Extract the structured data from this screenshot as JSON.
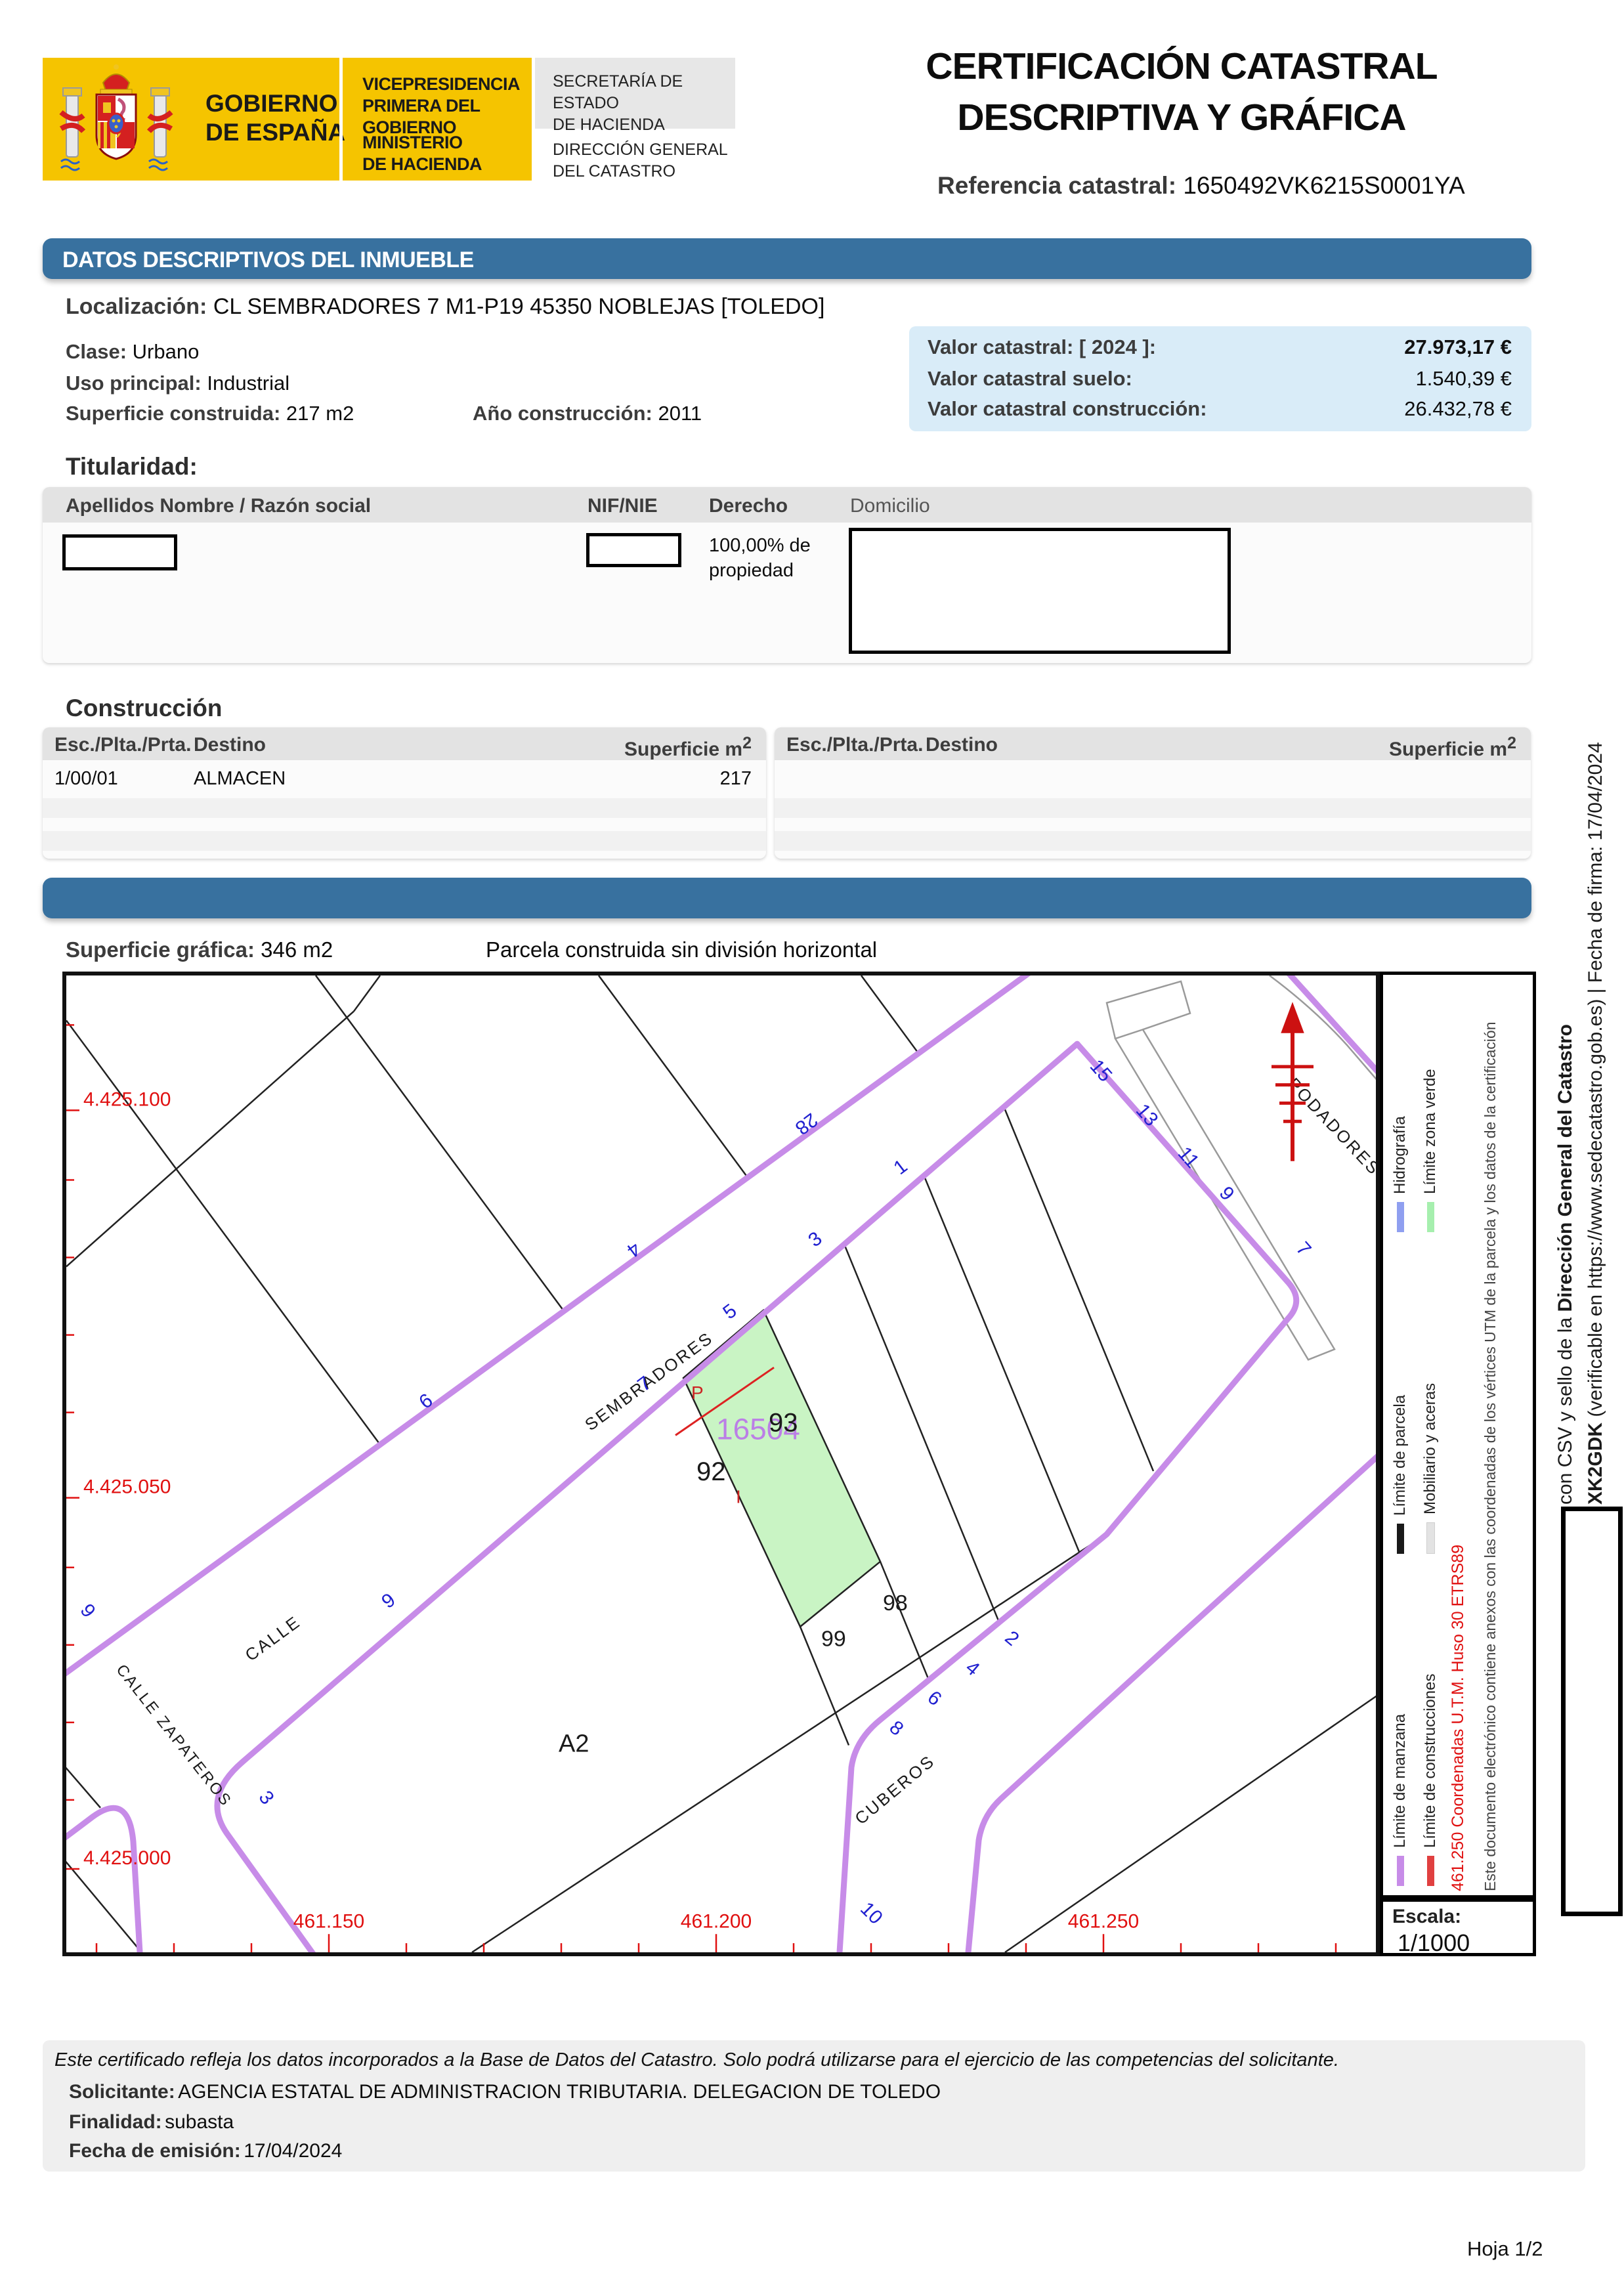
{
  "header": {
    "gobierno1": "GOBIERNO",
    "gobierno2": "DE ESPAÑA",
    "vicepresidencia1": "VICEPRESIDENCIA",
    "vicepresidencia2": "PRIMERA DEL GOBIERNO",
    "ministerio1": "MINISTERIO",
    "ministerio2": "DE HACIENDA",
    "secretaria1": "SECRETARÍA DE ESTADO",
    "secretaria2": "DE HACIENDA",
    "direccion1": "DIRECCIÓN GENERAL",
    "direccion2": "DEL CATASTRO",
    "title1": "CERTIFICACIÓN CATASTRAL",
    "title2": "DESCRIPTIVA Y GRÁFICA",
    "ref_label": "Referencia catastral:",
    "ref_value": "1650492VK6215S0001YA"
  },
  "datos": {
    "bar_title": "DATOS DESCRIPTIVOS DEL INMUEBLE",
    "localizacion_label": "Localización:",
    "localizacion": "CL SEMBRADORES 7 M1-P19 45350 NOBLEJAS [TOLEDO]",
    "clase_label": "Clase:",
    "clase": "Urbano",
    "uso_label": "Uso principal:",
    "uso": "Industrial",
    "superficie_label": "Superficie construida:",
    "superficie": "217 m2",
    "anio_label": "Año construcción:",
    "anio": "2011",
    "valor": {
      "label": "Valor catastral:",
      "year": "[ 2024 ]:",
      "total": "27.973,17 €",
      "suelo_label": "Valor catastral suelo:",
      "suelo": "1.540,39 €",
      "construccion_label": "Valor catastral construcción:",
      "construccion": "26.432,78 €"
    }
  },
  "titularidad": {
    "title": "Titularidad:",
    "headers": [
      "Apellidos Nombre / Razón social",
      "NIF/NIE",
      "Derecho",
      "Domicilio"
    ],
    "derecho1": "100,00% de",
    "derecho2": "propiedad"
  },
  "construccion": {
    "title": "Construcción",
    "col_esc": "Esc./Plta./Prta.",
    "col_destino": "Destino",
    "col_superficie": "Superficie m",
    "col_superficie_sup": "2",
    "rows": [
      {
        "esc": "1/00/01",
        "destino": "ALMACEN",
        "superficie": "217"
      }
    ]
  },
  "parcela": {
    "superficie_label": "Superficie gráfica:",
    "superficie": "346 m2",
    "nota": "Parcela construida sin división horizontal",
    "map": {
      "coords_y": [
        "4.425.100",
        "4.425.050",
        "4.425.000"
      ],
      "coords_x": [
        "461.150",
        "461.200",
        "461.250"
      ],
      "streets": {
        "calle": "CALLE",
        "sembradores": "SEMBRADORES",
        "zapateros": "CALLE ZAPATEROS",
        "cuberos": "CUBEROS",
        "podadores": "PODADORES"
      },
      "parcels": {
        "ref": "16504",
        "p92": "92",
        "p93": "93",
        "p98": "98",
        "p99": "99",
        "a2": "A2",
        "p": "P",
        "i": "I"
      },
      "numbers": {
        "n28": "28",
        "n4": "4",
        "n9a": "9",
        "n9b": "9",
        "n9c": "9",
        "n1": "1",
        "n3a": "3",
        "n5": "5",
        "n7a": "7",
        "n3b": "3",
        "n10": "10",
        "n15": "15",
        "n13": "13",
        "n11": "11",
        "n9d": "9",
        "n7b": "7",
        "n2": "2",
        "n4b": "4",
        "n6": "6",
        "n8": "8"
      }
    },
    "legend": {
      "items": [
        {
          "label": "Límite de manzana",
          "color": "#c78ce8"
        },
        {
          "label": "Límite de parcela",
          "color": "#1a1a1a"
        },
        {
          "label": "Hidrografía",
          "color": "#8f9ff0"
        },
        {
          "label": "Límite de construcciones",
          "color": "#e04040"
        },
        {
          "label": "Mobiliario y aceras",
          "color": "#e3e3e3"
        },
        {
          "label": "Límite zona verde",
          "color": "#a6efae"
        }
      ],
      "coord_line": "461.250 Coordenadas U.T.M. Huso 30 ETRS89",
      "note": "Este documento electrónico contiene anexos con las coordenadas de los vértices UTM de la parcela y los datos de la certificación",
      "escala_label": "Escala:",
      "escala": "1/1000"
    }
  },
  "firma": {
    "line1_pre": "con CSV y sello de la ",
    "line1_bold": "Dirección General del Catastro",
    "line2_bold": "XK2GDK",
    "line2_rest": " (verificable en https://www.sedecatastro.gob.es)  |  Fecha de firma: 17/04/2024"
  },
  "footer": {
    "aviso": "Este certificado refleja los datos incorporados a la Base de Datos del Catastro. Solo podrá utilizarse para el ejercicio de las competencias del solicitante.",
    "solicitante_label": "Solicitante:",
    "solicitante": "AGENCIA ESTATAL DE ADMINISTRACION TRIBUTARIA. DELEGACION DE TOLEDO",
    "finalidad_label": "Finalidad:",
    "finalidad": "subasta",
    "fecha_label": "Fecha de emisión:",
    "fecha": "17/04/2024",
    "hoja": "Hoja 1/2"
  }
}
